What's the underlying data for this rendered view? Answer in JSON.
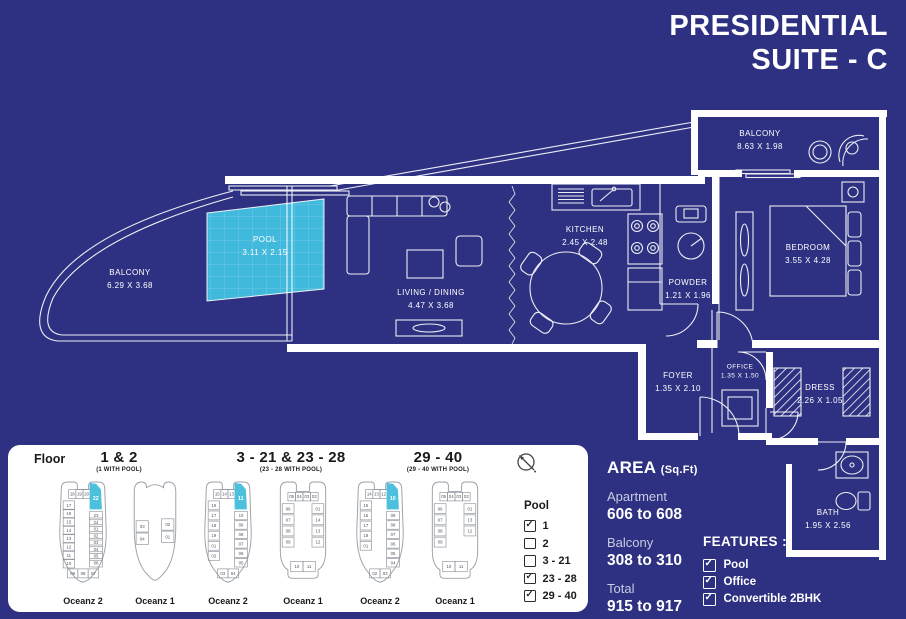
{
  "title": {
    "line1": "PRESIDENTIAL",
    "line2": "SUITE - C"
  },
  "plan": {
    "balcony_top": {
      "name": "BALCONY",
      "dims": "8.63 X 1.98"
    },
    "bedroom": {
      "name": "BEDROOM",
      "dims": "3.55 X 4.28"
    },
    "kitchen": {
      "name": "KITCHEN",
      "dims": "2.45 X 2.48"
    },
    "powder": {
      "name": "POWDER",
      "dims": "1.21 X 1.96"
    },
    "pool": {
      "name": "POOL",
      "dims": "3.11 X 2.15"
    },
    "balcony_left": {
      "name": "BALCONY",
      "dims": "6.29 X 3.68"
    },
    "living": {
      "name": "LIVING / DINING",
      "dims": "4.47 X 3.68"
    },
    "foyer": {
      "name": "FOYER",
      "dims": "1.35 X 2.10"
    },
    "office": {
      "name": "OFFICE",
      "dims": "1.35 X 1.50"
    },
    "dress": {
      "name": "DRESS",
      "dims": "2.26 X 1.05"
    },
    "bath": {
      "name": "BATH",
      "dims": "1.95 X 2.56"
    }
  },
  "floors": {
    "label": "Floor",
    "groups": [
      {
        "range": "1 & 2",
        "note": "(1 WITH POOL)"
      },
      {
        "range": "3 - 21 & 23 - 28",
        "note": "(23 - 28 WITH POOL)"
      },
      {
        "range": "29 - 40",
        "note": "(29 - 40 WITH POOL)"
      }
    ],
    "plans": [
      {
        "building": "Oceanz 2",
        "type": "o2",
        "highlight": "22",
        "top": [
          "18",
          "19",
          "20",
          "21"
        ],
        "left": [
          "17",
          "16",
          "15",
          "14",
          "13",
          "12",
          "11",
          "10"
        ],
        "right": [
          "23",
          "24",
          "01",
          "02",
          "03",
          "04",
          "05",
          "06"
        ],
        "bottom": [
          "09",
          "08",
          "07"
        ]
      },
      {
        "building": "Oceanz 1",
        "type": "o1s",
        "highlight": "",
        "top": [],
        "left": [
          "03",
          "04"
        ],
        "right": [
          "02",
          "01"
        ],
        "bottom": []
      },
      {
        "building": "Oceanz 2",
        "type": "o2",
        "highlight": "11",
        "top": [
          "15",
          "14",
          "13",
          "12"
        ],
        "left": [
          "16",
          "17",
          "18",
          "19",
          "01",
          "02"
        ],
        "right": [
          "10",
          "09",
          "08",
          "07",
          "06",
          "05"
        ],
        "bottom": [
          "03",
          "04"
        ]
      },
      {
        "building": "Oceanz 1",
        "type": "o1",
        "highlight": "",
        "top": [
          "05",
          "04",
          "03",
          "02"
        ],
        "left": [
          "06",
          "07",
          "08",
          "09"
        ],
        "right": [
          "01",
          "14",
          "13",
          "12"
        ],
        "bottom": [
          "10",
          "11"
        ]
      },
      {
        "building": "Oceanz 2",
        "type": "o2",
        "highlight": "10",
        "top": [
          "14",
          "13",
          "12",
          "11"
        ],
        "left": [
          "15",
          "16",
          "17",
          "18",
          "01"
        ],
        "right": [
          "09",
          "08",
          "07",
          "06",
          "05",
          "04"
        ],
        "bottom": [
          "02",
          "03"
        ]
      },
      {
        "building": "Oceanz 1",
        "type": "o1",
        "highlight": "",
        "top": [
          "05",
          "04",
          "03",
          "02"
        ],
        "left": [
          "06",
          "07",
          "08",
          "09"
        ],
        "right": [
          "01",
          "13",
          "12"
        ],
        "bottom": [
          "10",
          "11"
        ]
      }
    ],
    "legend": {
      "title": "Pool",
      "items": [
        {
          "label": "1",
          "checked": true
        },
        {
          "label": "2",
          "checked": false
        },
        {
          "label": "3 - 21",
          "checked": false
        },
        {
          "label": "23 - 28",
          "checked": true
        },
        {
          "label": "29 - 40",
          "checked": true
        }
      ]
    },
    "compass_icon": "north-arrow"
  },
  "area": {
    "heading": "AREA",
    "unit": "(Sq.Ft)",
    "rows": [
      {
        "label": "Apartment",
        "value": "606 to 608"
      },
      {
        "label": "Balcony",
        "value": "308 to 310"
      },
      {
        "label": "Total",
        "value": "915 to 917"
      }
    ]
  },
  "features": {
    "heading": "FEATURES :",
    "items": [
      {
        "label": "Pool",
        "checked": true
      },
      {
        "label": "Office",
        "checked": true
      },
      {
        "label": "Convertible 2BHK",
        "checked": true
      }
    ]
  },
  "colors": {
    "background": "#2e3181",
    "pool": "#41b9dd",
    "unit_highlight": "#4cc0dd",
    "line": "#ffffff",
    "panel": "#ffffff",
    "ink": "#1a1a1a"
  }
}
